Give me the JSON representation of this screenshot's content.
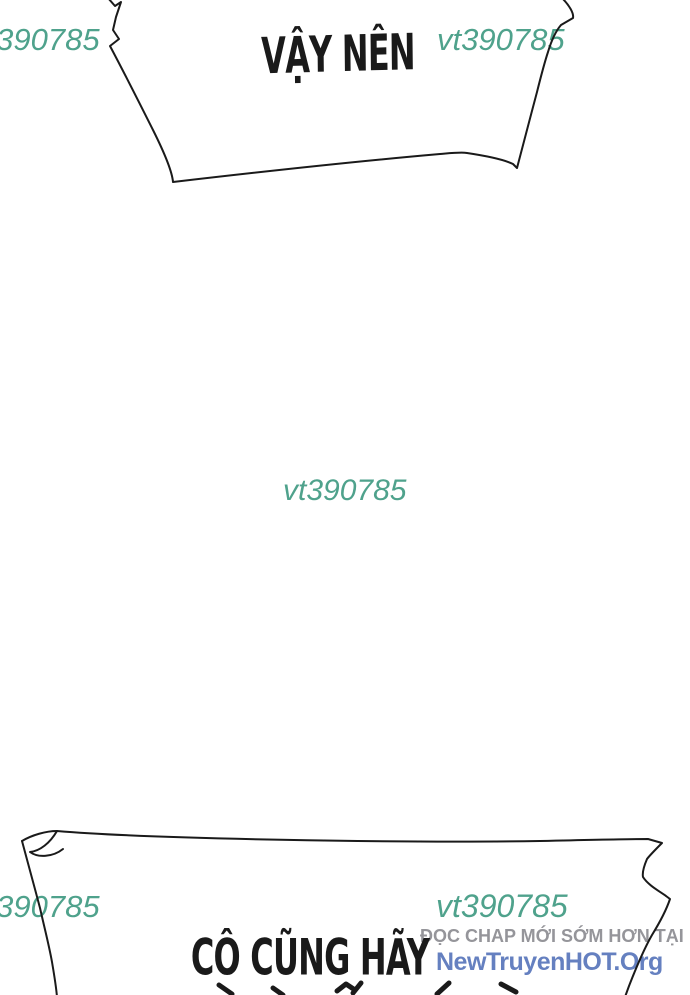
{
  "colors": {
    "ink": "#1a1a1a",
    "watermark_teal": "#4fa28c",
    "promo_gray": "#95959a",
    "promo_blue": "#6580c0",
    "background": "#ffffff"
  },
  "top_bubble": {
    "text": "VẬY NÊN"
  },
  "bottom_bubble": {
    "text_line1": "CÔ CŨNG HÃY"
  },
  "watermarks": {
    "top_left": "vt390785",
    "top_right": "vt390785",
    "center": "vt390785",
    "bottom_left": "vt390785",
    "bottom_right": "vt390785"
  },
  "promo": {
    "line1": "ĐỌC CHAP MỚI SỚM HƠN TẠI",
    "line2": "NewTruyenHOT.Org"
  }
}
